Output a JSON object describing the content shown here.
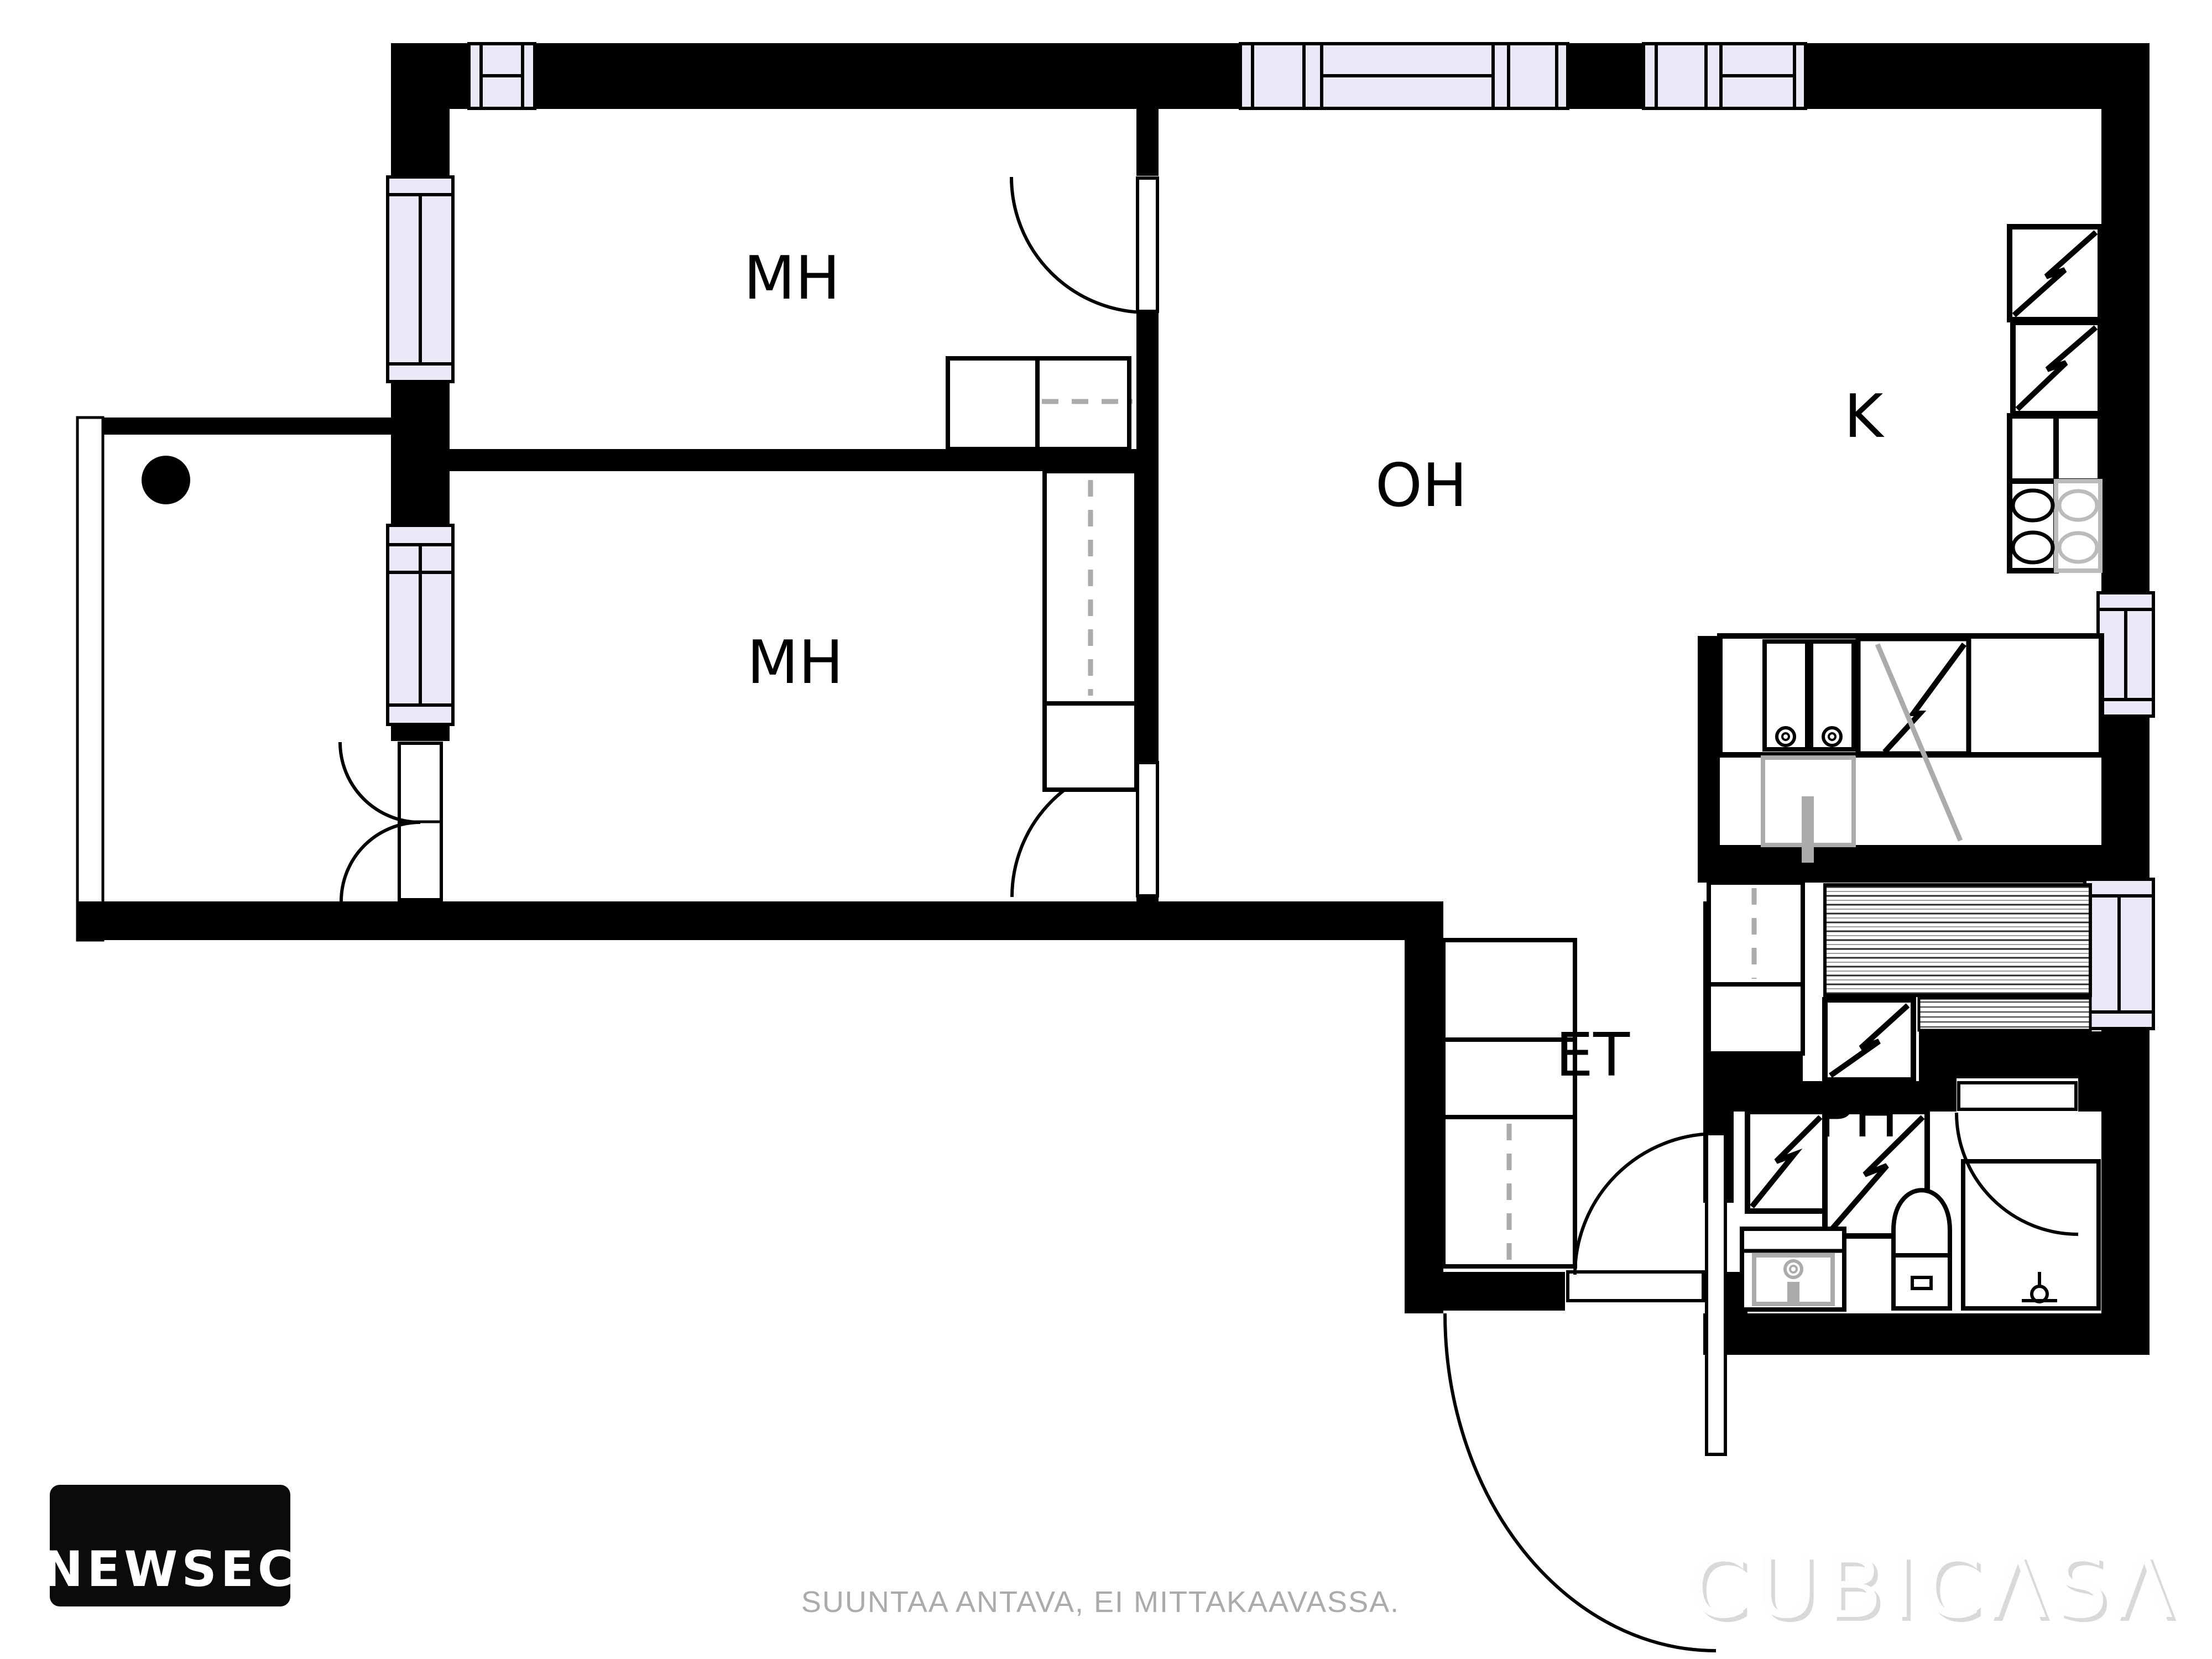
{
  "colors": {
    "wall": "#000000",
    "window_fill": "#E9E9F8",
    "fixture_gray": "#ABABAB",
    "dash_gray": "#ABABAB",
    "muted_gray": "#ABABAB",
    "watermark_shadow": "#D9D9D9",
    "watermark_fill": "#FDFDFD",
    "background": "#FFFFFF",
    "logo_bg": "#0B0B0B"
  },
  "rooms": [
    {
      "id": "bedroom-1",
      "label": "MH"
    },
    {
      "id": "bedroom-2",
      "label": "MH"
    },
    {
      "id": "living-room",
      "label": "OH"
    },
    {
      "id": "kitchen",
      "label": "K"
    },
    {
      "id": "entry-hall",
      "label": "ET"
    },
    {
      "id": "bathroom",
      "label": "PH"
    }
  ],
  "footer": {
    "disclaimer": "SUUNTAA ANTAVA, EI MITTAKAAVASSA."
  },
  "logo": {
    "text": "NEWSEC"
  },
  "watermark": {
    "text": "CUBICΛSΛ"
  }
}
